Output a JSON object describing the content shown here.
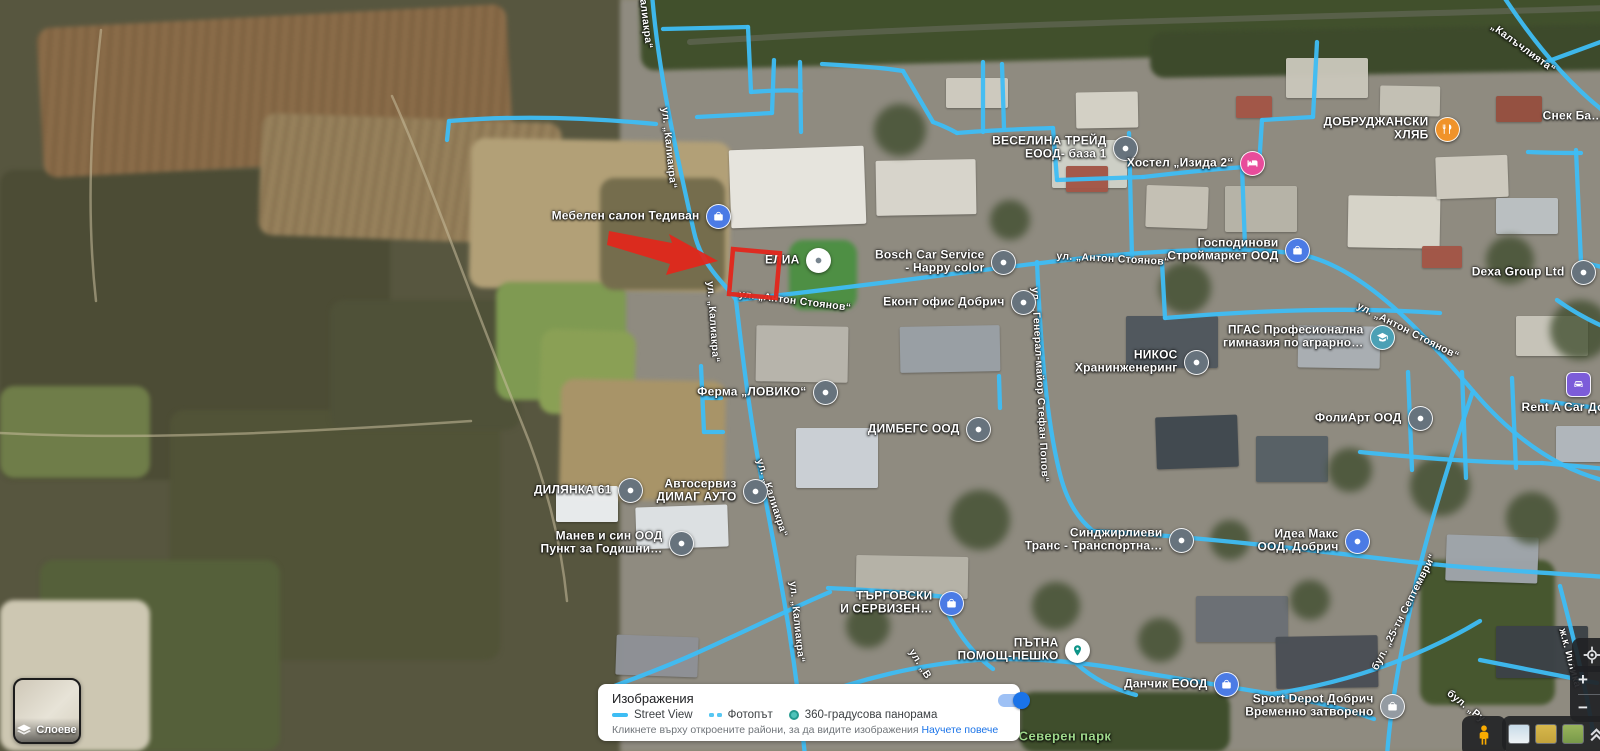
{
  "colors": {
    "street_view_blue": "#3EBDF4",
    "annotation_red": "#E3261B",
    "link_blue": "#1a73e8",
    "park_green": "#9fd98b",
    "toggle_on_blue": "#1a73e8"
  },
  "map": {
    "pois": [
      {
        "name": "Мебелен салон Тедиван",
        "icon": "bag-blue",
        "x": 718,
        "y": 216,
        "side": "left"
      },
      {
        "name": "ЕЛИА",
        "icon": "dot-white",
        "x": 818,
        "y": 260,
        "side": "left"
      },
      {
        "name": "ВЕСЕЛИНА ТРЕЙД",
        "name2": "ЕООД- база 1",
        "icon": "dot-gray",
        "x": 1125,
        "y": 148,
        "side": "left"
      },
      {
        "name": "Хостел „Изида 2“",
        "icon": "bed-pink",
        "x": 1252,
        "y": 163,
        "side": "left"
      },
      {
        "name": "ДОБРУДЖАНСКИ",
        "name2": "ХЛЯБ",
        "icon": "food-orange",
        "x": 1447,
        "y": 129,
        "side": "left"
      },
      {
        "name": "Господинови",
        "name2": "Строймаркет ООД",
        "icon": "bag-blue",
        "x": 1297,
        "y": 250,
        "side": "left"
      },
      {
        "name": "Dexa Group Ltd",
        "icon": "dot-gray",
        "x": 1583,
        "y": 272,
        "side": "left"
      },
      {
        "name": "Bosch Car Service",
        "name2": "- Happy color",
        "icon": "dot-gray",
        "x": 1003,
        "y": 262,
        "side": "left"
      },
      {
        "name": "Еконт офис Добрич",
        "icon": "dot-gray",
        "x": 1023,
        "y": 302,
        "side": "left"
      },
      {
        "name": "НИКОС",
        "name2": "Хранинженеринг",
        "icon": "dot-gray",
        "x": 1196,
        "y": 362,
        "side": "left"
      },
      {
        "name": "ПГАС Професионална",
        "name2": "гимназия по аграрно…",
        "icon": "school-teal",
        "x": 1382,
        "y": 337,
        "side": "left"
      },
      {
        "name": "Ферма „ЛОВИКО“",
        "icon": "dot-gray",
        "x": 825,
        "y": 392,
        "side": "left"
      },
      {
        "name": "ДИМБЕГС ООД",
        "icon": "dot-gray",
        "x": 978,
        "y": 429,
        "side": "left"
      },
      {
        "name": "ФолиАрт ООД",
        "icon": "dot-gray",
        "x": 1420,
        "y": 418,
        "side": "left"
      },
      {
        "name": "Rent A Car Добрич",
        "icon": "car-purple",
        "x": 1578,
        "y": 384,
        "side": "below"
      },
      {
        "name": "ДИЛЯНКА 61",
        "icon": "dot-gray",
        "x": 630,
        "y": 490,
        "side": "left"
      },
      {
        "name": "Автосервиз",
        "name2": "ДИМАГ АУТО",
        "icon": "dot-gray",
        "x": 755,
        "y": 491,
        "side": "left"
      },
      {
        "name": "Манев и син ООД",
        "name2": "Пункт за Годишни…",
        "icon": "dot-gray",
        "x": 681,
        "y": 543,
        "side": "left"
      },
      {
        "name": "ТЪРГОВСКИ",
        "name2": "И СЕРВИЗЕН…",
        "icon": "bag-blue",
        "x": 951,
        "y": 603,
        "side": "left"
      },
      {
        "name": "ПЪТНА",
        "name2": "ПОМОЩ-ПЕШКО",
        "icon": "pin-teal",
        "x": 1077,
        "y": 650,
        "side": "left"
      },
      {
        "name": "Синджирлиеви",
        "name2": "Транс - Транспортна…",
        "icon": "dot-gray",
        "x": 1181,
        "y": 540,
        "side": "left"
      },
      {
        "name": "Идеа Макс",
        "name2": "ООД, Добрич",
        "icon": "dot-blue",
        "x": 1357,
        "y": 541,
        "side": "left"
      },
      {
        "name": "Данчик ЕООД",
        "icon": "bag-blue",
        "x": 1226,
        "y": 684,
        "side": "left"
      },
      {
        "name": "Sport Depot Добрич",
        "name2": "Временно затворено",
        "icon": "bag-gray",
        "x": 1392,
        "y": 706,
        "side": "left"
      },
      {
        "name": "Снек Ба…",
        "icon": "none",
        "x": 1622,
        "y": 116,
        "side": "left"
      }
    ],
    "street_labels": [
      {
        "text": "алиакра“",
        "x": 646,
        "y": 24,
        "rot": 83
      },
      {
        "text": "ул. „Калиакра“",
        "x": 669,
        "y": 148,
        "rot": 84
      },
      {
        "text": "ул. „Калиакра“",
        "x": 713,
        "y": 322,
        "rot": 86
      },
      {
        "text": "ул. „Калиакра“",
        "x": 772,
        "y": 498,
        "rot": 72
      },
      {
        "text": "ул. „Калиакра“",
        "x": 797,
        "y": 622,
        "rot": 84
      },
      {
        "text": "ул. „Антон Стоянов“",
        "x": 795,
        "y": 301,
        "rot": 7
      },
      {
        "text": "ул. „Антон Стоянов“",
        "x": 1113,
        "y": 259,
        "rot": 3
      },
      {
        "text": "ул. „Антон Стоянов“",
        "x": 1408,
        "y": 331,
        "rot": 27
      },
      {
        "text": "ул. „Генерал-майор Стефан Попов“",
        "x": 1040,
        "y": 385,
        "rot": 87
      },
      {
        "text": "бул. „25-ти Септември“",
        "x": 1404,
        "y": 612,
        "rot": -63
      },
      {
        "text": "„Калъчлията“",
        "x": 1523,
        "y": 48,
        "rot": 36
      },
      {
        "text": "бул. „Ру",
        "x": 1466,
        "y": 706,
        "rot": 38
      },
      {
        "text": "ж.к. Иглика",
        "x": 1570,
        "y": 658,
        "rot": 75
      },
      {
        "text": "ул. „В",
        "x": 920,
        "y": 664,
        "rot": 58
      },
      {
        "text": "Северен парк",
        "x": 1065,
        "y": 736,
        "rot": 0,
        "kind": "park"
      }
    ]
  },
  "imagery_panel": {
    "title": "Изображения",
    "legend": [
      {
        "label": "Street View",
        "swatch": "solid-line"
      },
      {
        "label": "Фотопът",
        "swatch": "dashed-line"
      },
      {
        "label": "360-градусова панорама",
        "swatch": "circle"
      }
    ],
    "caption": "Кликнете върху откроените райони, за да видите изображения",
    "link": "Научете повече",
    "toggle_on": true
  },
  "layers_button": {
    "label": "Слоеве"
  },
  "zoom_controls": {
    "zoom_in": "+",
    "zoom_out": "−"
  }
}
